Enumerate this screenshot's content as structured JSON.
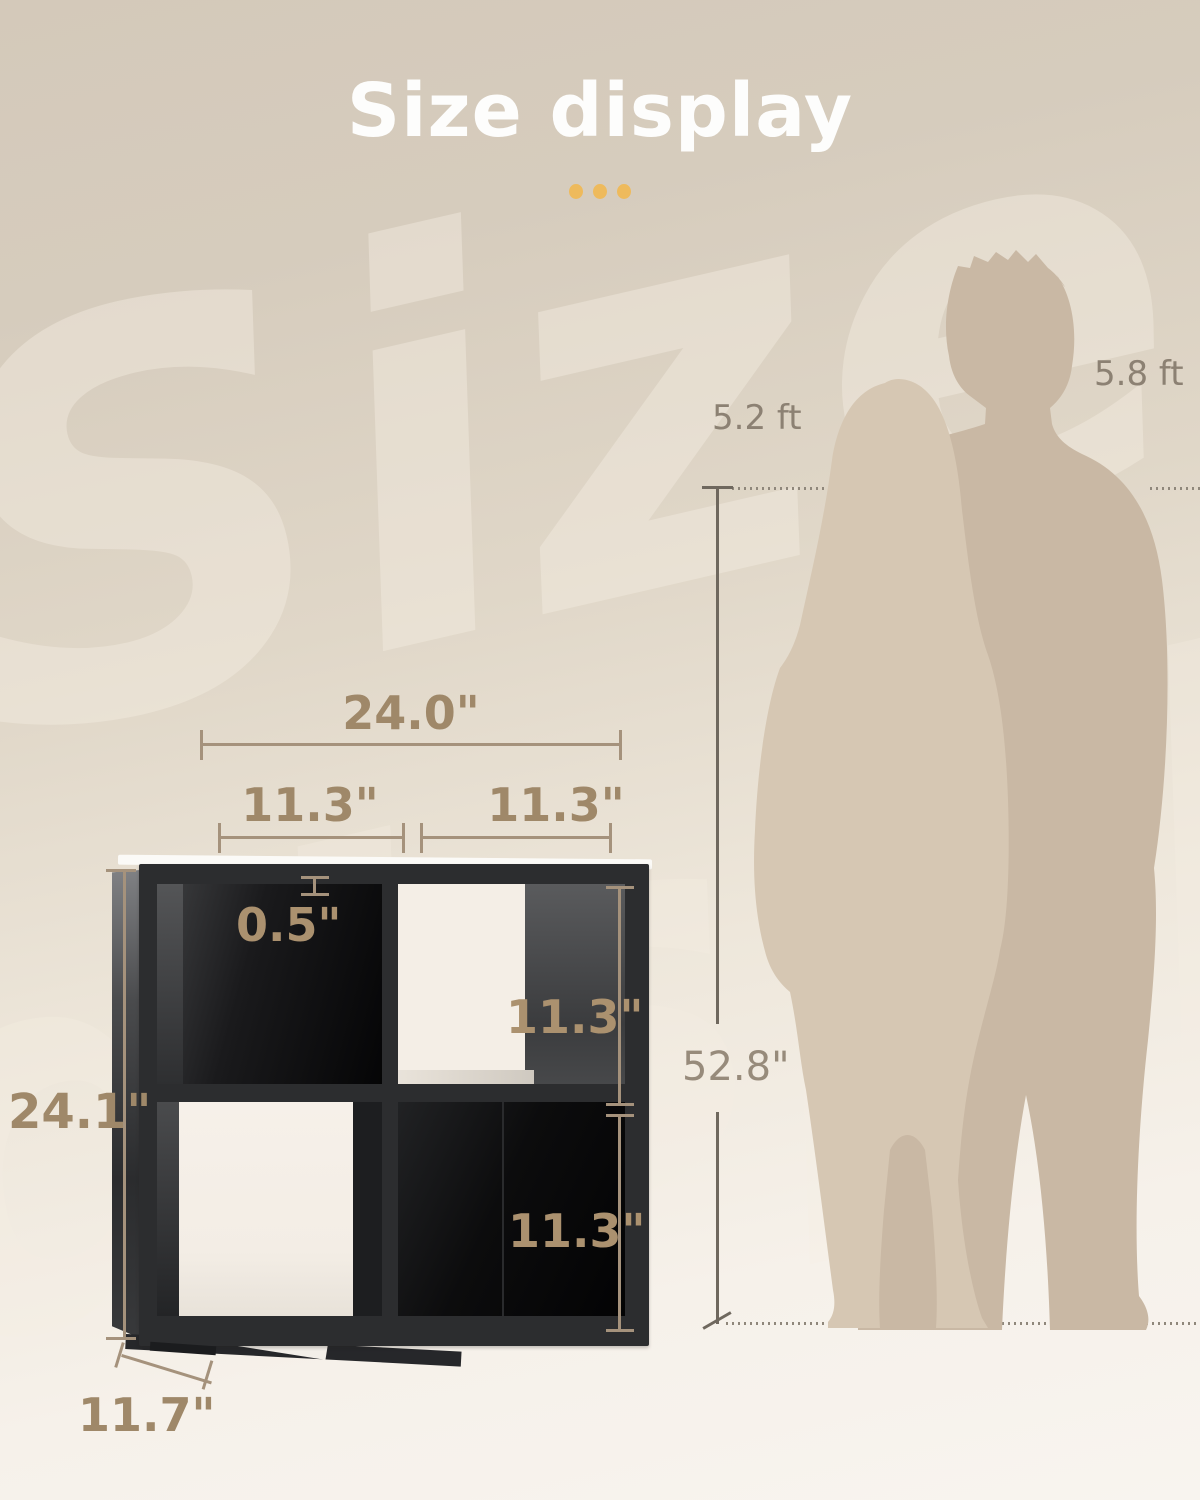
{
  "header": {
    "title": "Size display"
  },
  "watermark": {
    "line1": "Size",
    "line2": "display"
  },
  "annotations": {
    "total_width": "24.0\"",
    "left_cube_width": "11.3\"",
    "right_cube_width": "11.3\"",
    "shelf_thickness": "0.5\"",
    "top_cube_height": "11.3\"",
    "bottom_cube_height": "11.3\"",
    "total_height": "24.1\"",
    "depth": "11.7\"",
    "comparison_height": "52.8\"",
    "female_height": "5.2 ft",
    "male_height": "5.8 ft"
  },
  "colors": {
    "background_top": "#d5cabb",
    "background_bottom": "#f7f2ee",
    "accent_gold": "#eeba5c",
    "dimension_text": "#9f8869",
    "dimension_line": "#a5927c",
    "comparison_line": "#6f685e",
    "guide_dotted": "#8f877b",
    "silhouette_female": "#d6c7b3",
    "silhouette_male": "#c9b8a4",
    "shelf_black": "#2c2d2f",
    "title_white": "#fdfdfc"
  }
}
